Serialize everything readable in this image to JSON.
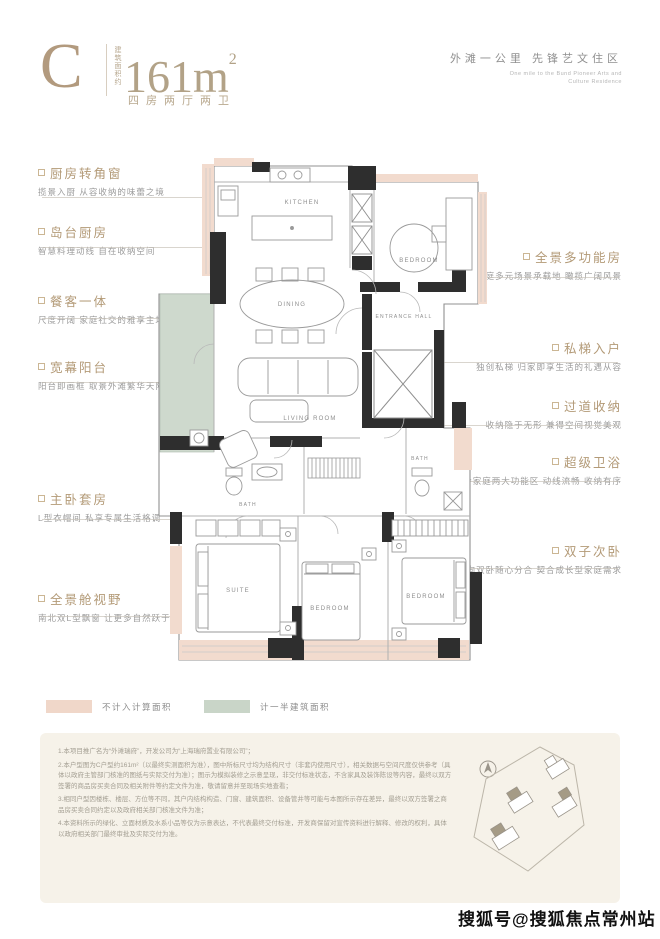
{
  "header": {
    "unit_type": "C",
    "area_note": "建筑面积约",
    "area_value": "161m",
    "area_sup": "2",
    "layout_text": "四房两厅两卫",
    "slogan_cn": "外滩一公里  先锋艺文住区",
    "slogan_en_line1": "One mile to the Bund Pioneer Arts and",
    "slogan_en_line2": "Culture Residence"
  },
  "annotations_left": [
    {
      "title": "厨房转角窗",
      "desc": "揽景入厨 从容收纳的味蕾之境"
    },
    {
      "title": "岛台厨房",
      "desc": "智慧料理动线 自在收纳空间"
    },
    {
      "title": "餐客一体",
      "desc": "尺度开阔 家庭社交的雅享主场"
    },
    {
      "title": "宽幕阳台",
      "desc": "阳台即画框 取景外滩繁华天际"
    },
    {
      "title": "主卧套房",
      "desc": "L型衣帽间 私享专属生活格调"
    },
    {
      "title": "全景舱视野",
      "desc": "南北双L型飘窗 让更多自然跃于眼前"
    }
  ],
  "annotations_right": [
    {
      "title": "全景多功能房",
      "desc": "家庭多元场景承载地 瞰揽广阔风景"
    },
    {
      "title": "私梯入户",
      "desc": "独创私梯 归家即享生活的礼遇从容"
    },
    {
      "title": "过道收纳",
      "desc": "收纳隐于无形 兼得空间视觉美观"
    },
    {
      "title": "超级卫浴",
      "desc": "整合家庭两大功能区 动线流畅 收纳有序"
    },
    {
      "title": "双子次卧",
      "desc": "南向双卧随心分合 契合成长型家庭需求"
    }
  ],
  "plan": {
    "kitchen": "KITCHEN",
    "dining": "DINING",
    "living": "LIVING ROOM",
    "multi_room": "BEDROOM",
    "entrance": "ENTRANCE HALL",
    "bath_main": "BATH",
    "bath_second": "BATH",
    "suite": "SUITE",
    "bedroom_mid": "BEDROOM",
    "bedroom_right": "BEDROOM",
    "colors": {
      "non_counted_area": "#f0d7c9",
      "half_counted_area": "#c9d5c8",
      "wall": "#2e2e2e"
    }
  },
  "legend": {
    "items": [
      {
        "label": "不计入计算面积",
        "color": "#f0d7c9"
      },
      {
        "label": "计一半建筑面积",
        "color": "#c9d5c8"
      }
    ]
  },
  "disclaimer": {
    "line1": "1.本项目推广名为“外滩瑞府”，开发公司为“上海瑞府置业有限公司”；",
    "line2": "2.本户型图为C户型约161m²（以最终实测面积为准），图中所标尺寸均为结构尺寸（非套内使用尺寸），相关数据与空间尺度仅供参考（具体以政府主管部门核准的图纸与实际交付为准）；图示为模拟装修之示意呈现，非交付标准状态，不含家具及装饰陈设等内容，最终以双方签署的商品房买卖合同及相关附件等约定文件为准，敬请留意并至现场实地查看；",
    "line3": "3.相同户型因楼栋、楼层、方位等不同，其户内结构构造、门窗、建筑面积、设备管井等可能与本图所示存在差异，最终以双方签署之商品房买卖合同约定以及政府相关部门核准文件为准；",
    "line4": "4.本资料所示的绿化、立面材质及水系小品等仅为示意表达，不代表最终交付标准，开发商保留对宣传资料进行解释、修改的权利，具体以政府相关部门最终审批及实际交付为准。"
  },
  "watermark": "搜狐号@搜狐焦点常州站"
}
